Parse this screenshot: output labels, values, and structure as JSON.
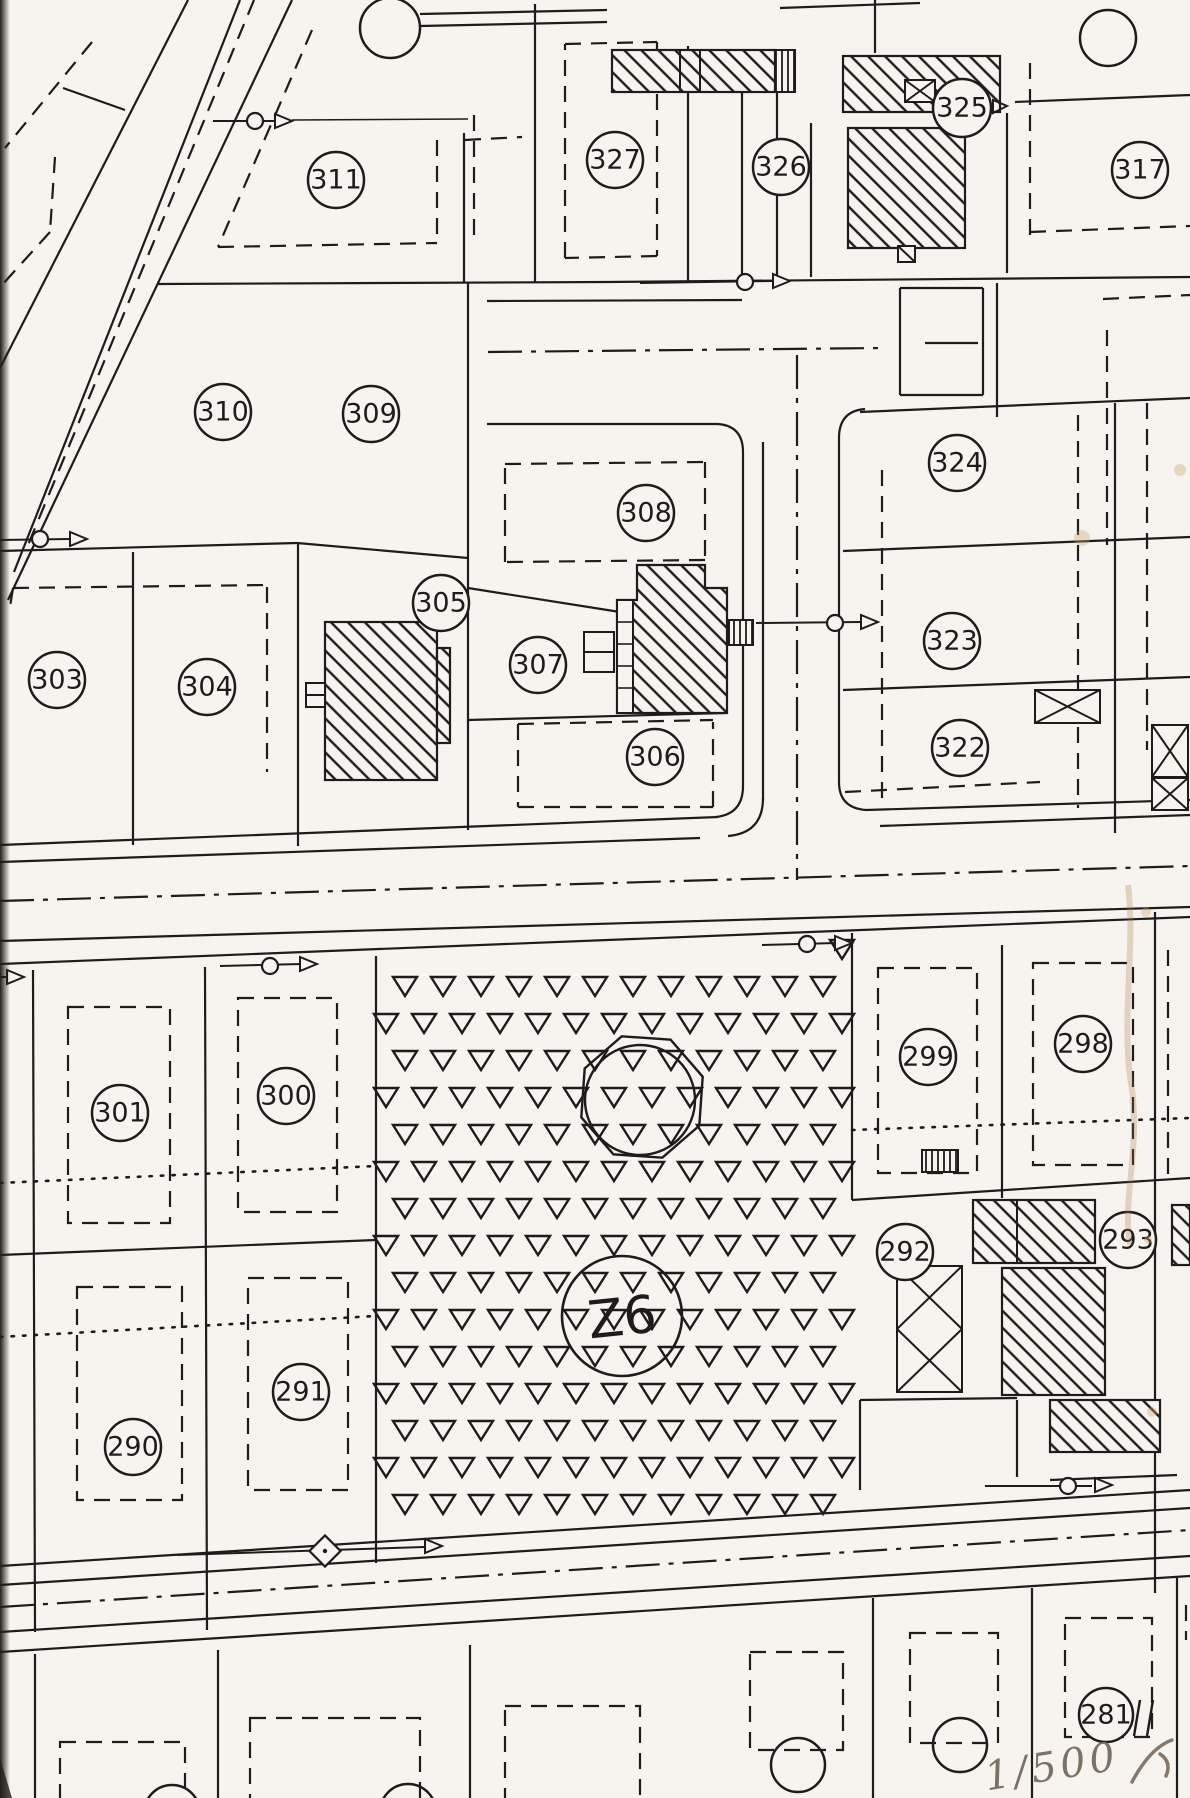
{
  "document": {
    "kind": "scanned cadastral parcel plan",
    "paper_color": "#f7f4ef",
    "ink_color": "#1c1c1c",
    "pencil_color": "#7b7165"
  },
  "map": {
    "parcels": [
      {
        "label": "311",
        "x": 336,
        "y": 180
      },
      {
        "label": "327",
        "x": 615,
        "y": 160
      },
      {
        "label": "326",
        "x": 781,
        "y": 167
      },
      {
        "label": "325",
        "x": 962,
        "y": 108,
        "r": 29
      },
      {
        "label": "317",
        "x": 1140,
        "y": 170
      },
      {
        "label": "310",
        "x": 223,
        "y": 412
      },
      {
        "label": "309",
        "x": 371,
        "y": 414
      },
      {
        "label": "324",
        "x": 957,
        "y": 463
      },
      {
        "label": "308",
        "x": 646,
        "y": 513
      },
      {
        "label": "305",
        "x": 441,
        "y": 603
      },
      {
        "label": "303",
        "x": 57,
        "y": 680
      },
      {
        "label": "304",
        "x": 207,
        "y": 687
      },
      {
        "label": "307",
        "x": 538,
        "y": 665
      },
      {
        "label": "323",
        "x": 952,
        "y": 641
      },
      {
        "label": "306",
        "x": 655,
        "y": 757
      },
      {
        "label": "322",
        "x": 960,
        "y": 748
      },
      {
        "label": "301",
        "x": 120,
        "y": 1113
      },
      {
        "label": "300",
        "x": 286,
        "y": 1096
      },
      {
        "label": "299",
        "x": 928,
        "y": 1057
      },
      {
        "label": "298",
        "x": 1083,
        "y": 1044
      },
      {
        "label": "292",
        "x": 905,
        "y": 1252
      },
      {
        "label": "293",
        "x": 1128,
        "y": 1240
      },
      {
        "label": "290",
        "x": 133,
        "y": 1447
      },
      {
        "label": "291",
        "x": 301,
        "y": 1392
      },
      {
        "label": "281",
        "x": 1106,
        "y": 1715,
        "r": 27
      }
    ],
    "reservoir": {
      "label": "Z6",
      "x": 622,
      "y": 1316,
      "r": 60
    }
  },
  "annotations": {
    "scale": "1/500"
  }
}
